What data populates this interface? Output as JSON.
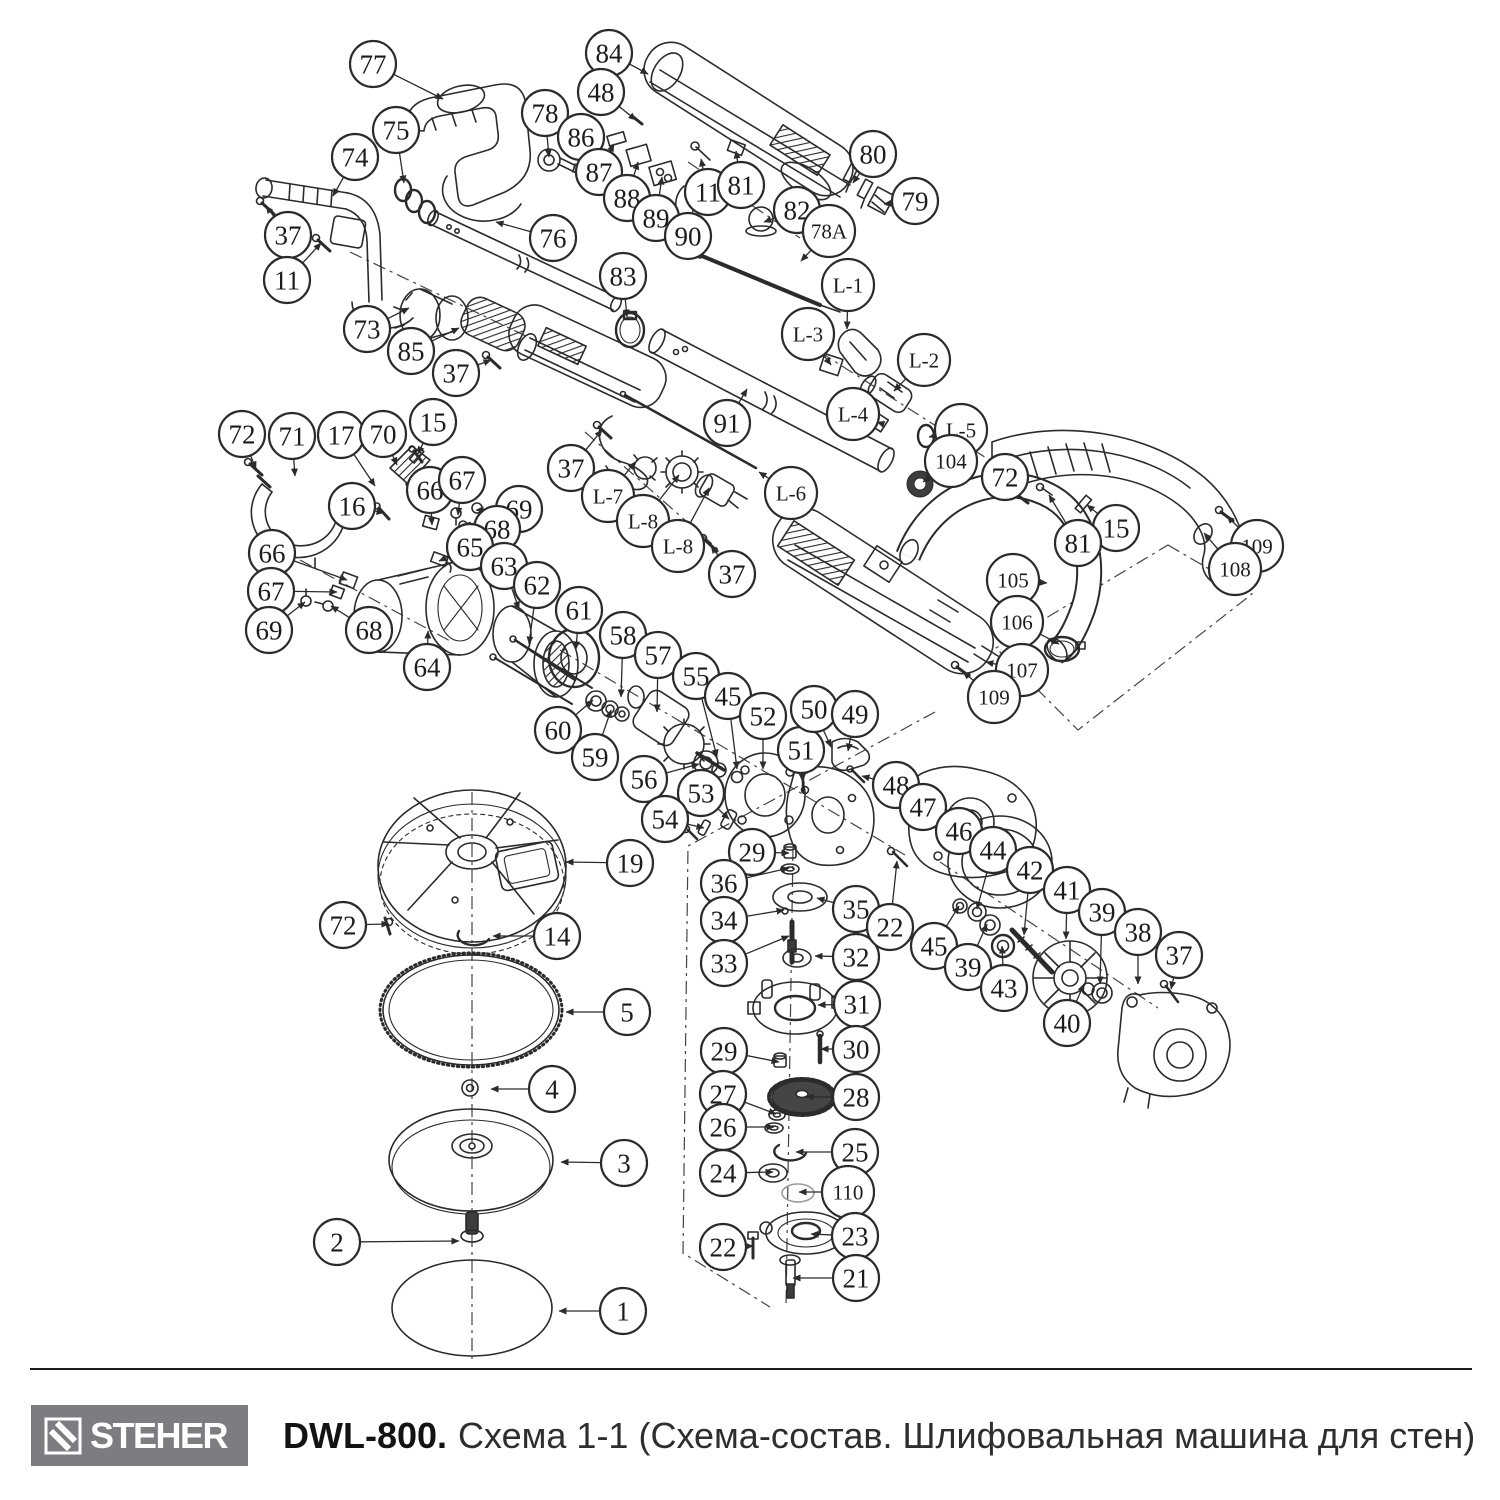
{
  "footer": {
    "brand": "STEHER",
    "model": "DWL-800.",
    "title": "Схема 1-1 (Схема-состав. Шлифовальная машина для стен)",
    "logo_bg": "#7d7d81"
  },
  "diagram": {
    "line_color": "#2b2b2b",
    "balloon_fill": "#ffffff",
    "callouts": [
      [
        "77",
        373,
        64,
        443,
        99
      ],
      [
        "84",
        609,
        53,
        648,
        74
      ],
      [
        "48",
        601,
        92,
        636,
        120
      ],
      [
        "78",
        545,
        113,
        549,
        157
      ],
      [
        "86",
        581,
        137,
        600,
        184
      ],
      [
        "87",
        599,
        172,
        614,
        144
      ],
      [
        "88",
        627,
        198,
        638,
        162
      ],
      [
        "89",
        656,
        218,
        662,
        177
      ],
      [
        "90",
        688,
        236,
        695,
        199
      ],
      [
        "11",
        708,
        192,
        701,
        159
      ],
      [
        "81",
        741,
        185,
        736,
        151
      ],
      [
        "82",
        797,
        210,
        764,
        222
      ],
      [
        "78A",
        829,
        231,
        801,
        261
      ],
      [
        "80",
        873,
        154,
        853,
        183
      ],
      [
        "79",
        915,
        201,
        884,
        204
      ],
      [
        "75",
        396,
        130,
        404,
        183
      ],
      [
        "74",
        355,
        157,
        333,
        196
      ],
      [
        "37",
        288,
        235,
        266,
        206
      ],
      [
        "11",
        287,
        280,
        321,
        243
      ],
      [
        "76",
        553,
        238,
        496,
        222
      ],
      [
        "83",
        623,
        276,
        627,
        317
      ],
      [
        "73",
        367,
        329,
        409,
        308
      ],
      [
        "85",
        411,
        351,
        459,
        328
      ],
      [
        "37",
        456,
        373,
        491,
        360
      ],
      [
        "L-1",
        848,
        285,
        847,
        329
      ],
      [
        "L-3",
        808,
        334,
        831,
        365
      ],
      [
        "L-2",
        924,
        360,
        894,
        391
      ],
      [
        "L-4",
        853,
        414,
        877,
        422
      ],
      [
        "L-5",
        961,
        430,
        929,
        437
      ],
      [
        "91",
        727,
        423,
        747,
        389
      ],
      [
        "104",
        951,
        461,
        923,
        482
      ],
      [
        "72",
        1005,
        477,
        1021,
        498
      ],
      [
        "15",
        1116,
        528,
        1087,
        505
      ],
      [
        "81",
        1078,
        543,
        1049,
        495
      ],
      [
        "109",
        1257,
        546,
        1227,
        516
      ],
      [
        "108",
        1235,
        569,
        1204,
        533
      ],
      [
        "105",
        1013,
        580,
        1047,
        583
      ],
      [
        "106",
        1017,
        622,
        1059,
        644
      ],
      [
        "107",
        1022,
        670,
        986,
        662
      ],
      [
        "109",
        994,
        697,
        963,
        672
      ],
      [
        "37",
        571,
        468,
        602,
        430
      ],
      [
        "L-7",
        608,
        496,
        635,
        462
      ],
      [
        "L-8",
        643,
        521,
        679,
        475
      ],
      [
        "L-8",
        678,
        546,
        709,
        488
      ],
      [
        "L-6",
        791,
        493,
        759,
        472
      ],
      [
        "37",
        732,
        574,
        711,
        546
      ],
      [
        "72",
        242,
        434,
        256,
        469
      ],
      [
        "71",
        292,
        436,
        295,
        476
      ],
      [
        "17",
        341,
        435,
        375,
        486
      ],
      [
        "70",
        383,
        434,
        397,
        465
      ],
      [
        "15",
        433,
        422,
        418,
        454
      ],
      [
        "16",
        352,
        506,
        384,
        513
      ],
      [
        "66",
        430,
        490,
        432,
        525
      ],
      [
        "67",
        462,
        480,
        458,
        515
      ],
      [
        "69",
        519,
        509,
        476,
        510
      ],
      [
        "68",
        497,
        529,
        463,
        524
      ],
      [
        "65",
        470,
        547,
        439,
        561
      ],
      [
        "66",
        272,
        553,
        347,
        580
      ],
      [
        "67",
        271,
        591,
        337,
        592
      ],
      [
        "69",
        269,
        630,
        305,
        602
      ],
      [
        "68",
        369,
        630,
        331,
        606
      ],
      [
        "63",
        504,
        566,
        519,
        609
      ],
      [
        "62",
        537,
        585,
        529,
        644
      ],
      [
        "64",
        427,
        667,
        428,
        631
      ],
      [
        "61",
        579,
        610,
        576,
        649
      ],
      [
        "58",
        623,
        635,
        621,
        697
      ],
      [
        "57",
        658,
        655,
        657,
        712
      ],
      [
        "55",
        696,
        676,
        717,
        757
      ],
      [
        "45",
        728,
        696,
        737,
        769
      ],
      [
        "52",
        763,
        716,
        763,
        769
      ],
      [
        "51",
        801,
        750,
        803,
        781
      ],
      [
        "50",
        814,
        709,
        831,
        747
      ],
      [
        "49",
        855,
        714,
        848,
        751
      ],
      [
        "48",
        896,
        785,
        862,
        776
      ],
      [
        "60",
        558,
        730,
        593,
        700
      ],
      [
        "59",
        595,
        757,
        611,
        710
      ],
      [
        "56",
        644,
        779,
        699,
        764
      ],
      [
        "53",
        701,
        793,
        729,
        819
      ],
      [
        "54",
        665,
        819,
        704,
        828
      ],
      [
        "47",
        923,
        807,
        949,
        831
      ],
      [
        "29",
        752,
        852,
        789,
        853
      ],
      [
        "36",
        724,
        883,
        789,
        868
      ],
      [
        "35",
        856,
        909,
        817,
        898
      ],
      [
        "34",
        724,
        920,
        784,
        910
      ],
      [
        "33",
        724,
        963,
        789,
        936
      ],
      [
        "32",
        856,
        957,
        815,
        956
      ],
      [
        "31",
        857,
        1004,
        818,
        1005
      ],
      [
        "30",
        856,
        1049,
        821,
        1049
      ],
      [
        "29",
        724,
        1051,
        779,
        1062
      ],
      [
        "22",
        890,
        927,
        897,
        861
      ],
      [
        "46",
        959,
        831,
        982,
        867
      ],
      [
        "45",
        934,
        946,
        959,
        906
      ],
      [
        "39",
        968,
        967,
        987,
        924
      ],
      [
        "44",
        993,
        850,
        977,
        909
      ],
      [
        "42",
        1030,
        870,
        1024,
        935
      ],
      [
        "41",
        1067,
        890,
        1066,
        939
      ],
      [
        "39",
        1102,
        912,
        1100,
        984
      ],
      [
        "38",
        1138,
        932,
        1138,
        984
      ],
      [
        "37",
        1179,
        955,
        1171,
        989
      ],
      [
        "43",
        1004,
        988,
        1002,
        946
      ],
      [
        "40",
        1067,
        1023,
        1084,
        984
      ],
      [
        "19",
        630,
        863,
        566,
        862
      ],
      [
        "72",
        343,
        925,
        389,
        924
      ],
      [
        "14",
        557,
        936,
        493,
        936
      ],
      [
        "5",
        627,
        1012,
        566,
        1012
      ],
      [
        "4",
        552,
        1089,
        491,
        1089
      ],
      [
        "3",
        624,
        1163,
        561,
        1162
      ],
      [
        "2",
        337,
        1242,
        459,
        1241
      ],
      [
        "1",
        623,
        1311,
        559,
        1311
      ],
      [
        "27",
        723,
        1094,
        776,
        1114
      ],
      [
        "28",
        856,
        1097,
        806,
        1097
      ],
      [
        "26",
        723,
        1127,
        774,
        1127
      ],
      [
        "25",
        855,
        1152,
        796,
        1152
      ],
      [
        "24",
        723,
        1173,
        773,
        1172
      ],
      [
        "110",
        848,
        1192,
        799,
        1192
      ],
      [
        "23",
        855,
        1236,
        811,
        1234
      ],
      [
        "22",
        723,
        1247,
        753,
        1246
      ],
      [
        "21",
        856,
        1278,
        793,
        1278
      ]
    ]
  }
}
